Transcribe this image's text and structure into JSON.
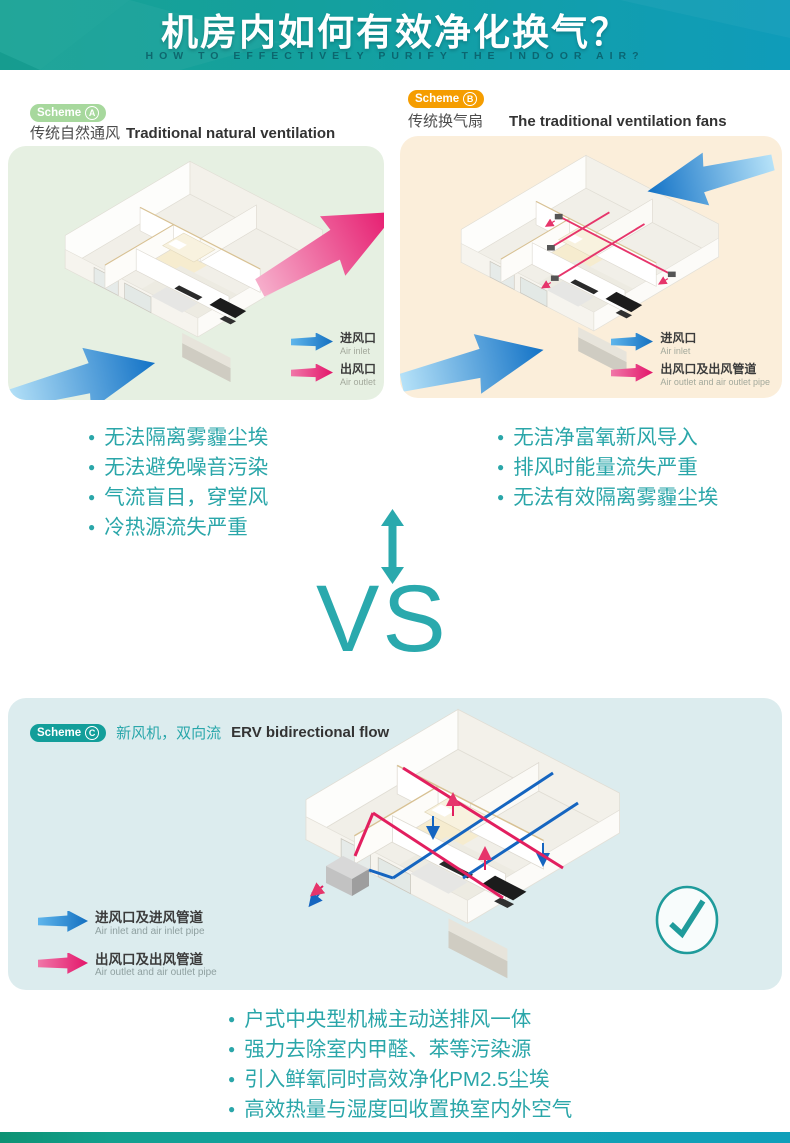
{
  "header": {
    "title": "机房内如何有效净化换气？",
    "subtitle": "HOW TO EFFECTIVELY PURIFY THE INDOOR AIR?"
  },
  "vs": {
    "label": "VS"
  },
  "schemes": {
    "a": {
      "badge_text": "Scheme",
      "badge_letter": "A",
      "title_zh": "传统自然通风",
      "title_en": "Traditional natural ventilation",
      "legend": [
        {
          "zh": "进风口",
          "en": "Air inlet"
        },
        {
          "zh": "出风口",
          "en": "Air outlet"
        }
      ],
      "cons": [
        "无法隔离雾霾尘埃",
        "无法避免噪音污染",
        "气流盲目，穿堂风",
        "冷热源流失严重"
      ]
    },
    "b": {
      "badge_text": "Scheme",
      "badge_letter": "B",
      "title_zh": "传统换气扇",
      "title_en": "The traditional ventilation fans",
      "legend": [
        {
          "zh": "进风口",
          "en": "Air inlet"
        },
        {
          "zh": "出风口及出风管道",
          "en": "Air outlet and air outlet pipe"
        }
      ],
      "cons": [
        "无洁净富氧新风导入",
        "排风时能量流失严重",
        "无法有效隔离雾霾尘埃"
      ]
    },
    "c": {
      "badge_text": "Scheme",
      "badge_letter": "C",
      "title_zh": "新风机，双向流",
      "title_en": "ERV bidirectional flow",
      "legend": [
        {
          "zh": "进风口及进风管道",
          "en": "Air inlet and air inlet pipe"
        },
        {
          "zh": "出风口及出风管道",
          "en": "Air outlet and air outlet pipe"
        }
      ],
      "pros": [
        "户式中央型机械主动送排风一体",
        "强力去除室内甲醛、苯等污染源",
        "引入鲜氧同时高效净化PM2.5尘埃",
        "高效热量与湿度回收置换室内外空气"
      ]
    }
  },
  "colors": {
    "header_gradient_left": "#17a294",
    "header_gradient_right": "#0f9cba",
    "teal_text": "#2aa6a9",
    "air_inlet_blue": "#1578c8",
    "air_outlet_pink": "#e6166b",
    "scheme_a_badge": "#a7d89d",
    "scheme_a_panel": "#e6f0e2",
    "scheme_b_badge": "#f59d00",
    "scheme_b_panel": "#fbeeda",
    "scheme_c_badge": "#139e9a",
    "scheme_c_panel": "#dcecee"
  }
}
